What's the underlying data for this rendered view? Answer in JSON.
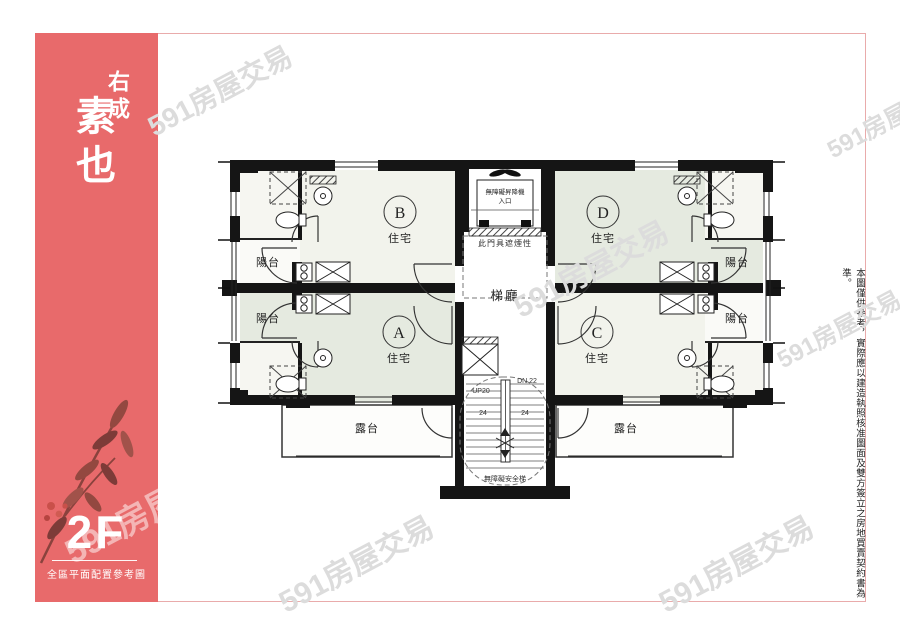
{
  "sidebar": {
    "brand_top": "右成",
    "brand_main": "素也",
    "floor": "2F",
    "caption": "全區平面配置參考圖"
  },
  "plan": {
    "hall": "梯廳",
    "door_note": "此門具遮煙性",
    "elevator_line1": "無障礙昇降機",
    "elevator_line2": "入口",
    "stair_up": "UP20",
    "stair_down": "DN 22",
    "stair_count_left": "24",
    "stair_count_right": "24",
    "stair_note": "無障礙安全梯",
    "balcony": "陽台",
    "terrace": "露台",
    "unit_type": "住宅",
    "units": {
      "a": "A",
      "b": "B",
      "c": "C",
      "d": "D"
    }
  },
  "disclaimer": "本圖僅供參考，實際應以建造執照核准圖面及雙方簽立之房地買賣契約書為準。",
  "watermark": {
    "text": "591房屋交易"
  },
  "colors": {
    "brand_coral": "#e86a6b",
    "unit_green": "#e5eae0",
    "unit_white": "#f2f3ec",
    "wall": "#151515",
    "frame_line": "#e9abab",
    "leaf": "#91453f",
    "berry": "#c9504a"
  }
}
